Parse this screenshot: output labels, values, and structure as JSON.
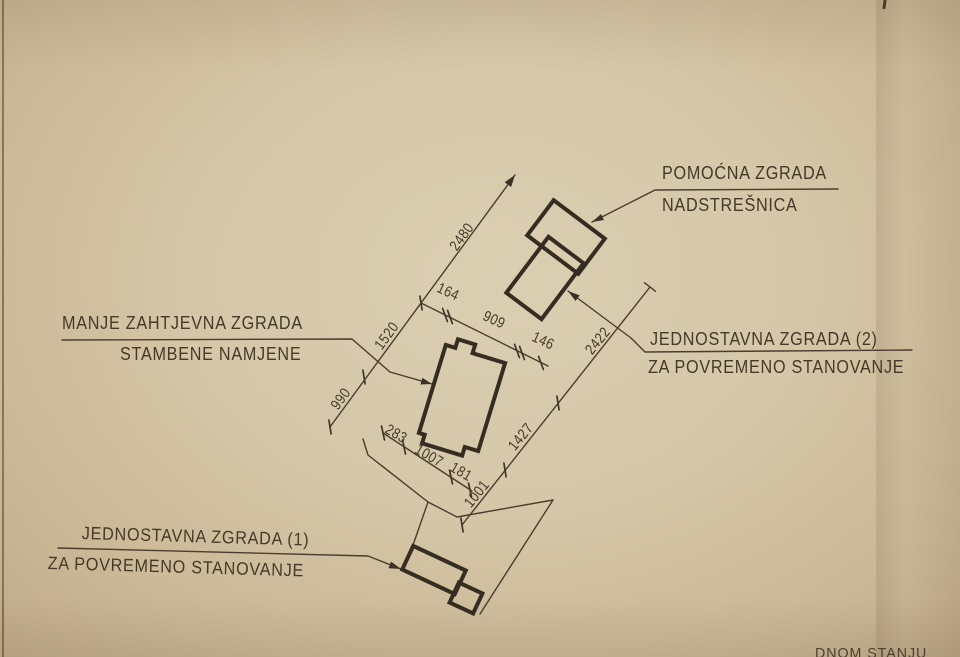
{
  "drawing": {
    "labels": {
      "auxiliary": {
        "line1": "POMOĆNA ZGRADA",
        "line2": "NADSTREŠNICA"
      },
      "residential": {
        "line1": "MANJE ZAHTJEVNA ZGRADA",
        "line2": "STAMBENE NAMJENE"
      },
      "simple2": {
        "line1": "JEDNOSTAVNA ZGRADA (2)",
        "line2": "ZA POVREMENO STANOVANJE"
      },
      "simple1": {
        "line1": "JEDNOSTAVNA ZGRADA (1)",
        "line2": "ZA POVREMENO STANOVANJE"
      },
      "corner_note": "DNOM STANJU"
    },
    "dimensions": {
      "site_chain_left": [
        "990",
        "1520",
        "2480"
      ],
      "width_chain": [
        "164",
        "909",
        "146"
      ],
      "site_chain_right": [
        "1001",
        "1427",
        "2422"
      ],
      "bottom_chain": [
        "283",
        "1007",
        "181"
      ]
    },
    "colors": {
      "paper": "#d5c7a8",
      "building_ink": "#362d22",
      "line_ink": "#4a3d2f"
    }
  }
}
